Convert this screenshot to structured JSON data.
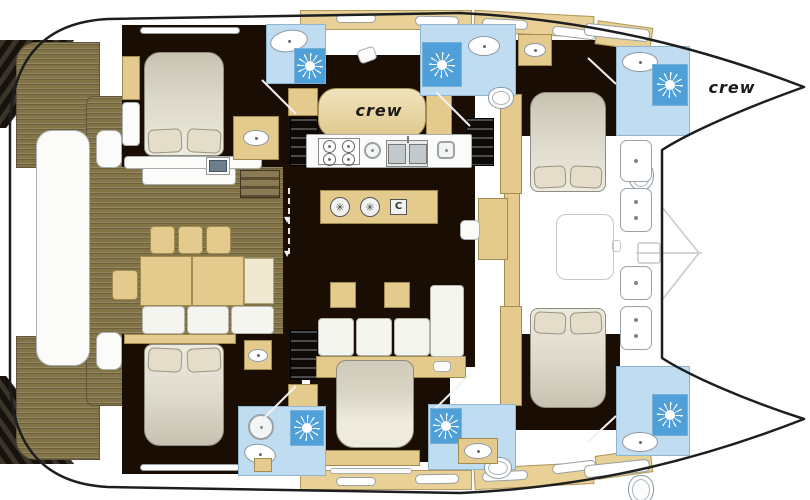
{
  "labels": {
    "crew_midship": "crew",
    "crew_bow": "crew"
  },
  "icons": {
    "shower": "sunburst-shower-icon",
    "sink": "oval-sink-icon",
    "toilet": "toilet-icon",
    "stove": "four-burner-hob-icon",
    "burner_glyph": "✳",
    "grill_glyph": "C",
    "arrow_down_glyph": "▼"
  },
  "colors": {
    "hull_white": "#ffffff",
    "outline": "#1c1e20",
    "deck_wood": "#837448",
    "cabin_floor": "#1a0d04",
    "furniture_tan": "#e5ca8e",
    "cream": "#f0e8d0",
    "mattress": "#dcd8ca",
    "bath_blue": "#bfdcf0",
    "shower_blue": "#4f9fd8",
    "fixture_white": "#fbfbf9"
  }
}
